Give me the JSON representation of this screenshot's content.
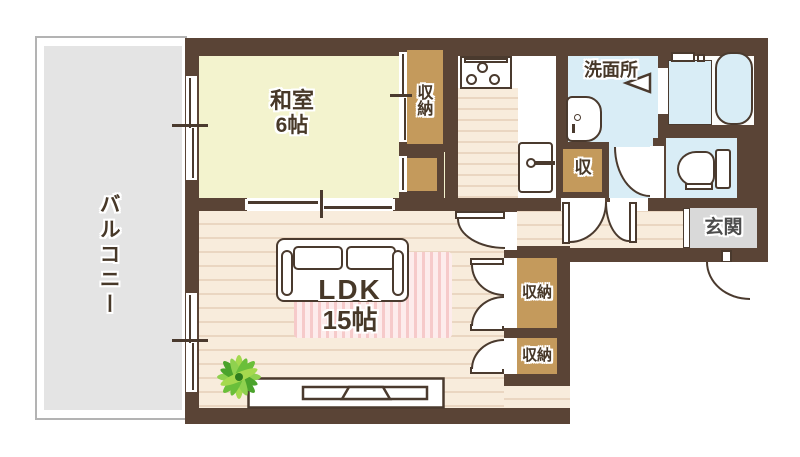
{
  "floorplan": {
    "rooms": {
      "balcony": {
        "label": "バルコニー"
      },
      "japanese_room": {
        "label": "和室",
        "size": "6帖"
      },
      "ldk": {
        "label": "LDK",
        "size": "15帖"
      },
      "washroom": {
        "label": "洗面所"
      },
      "entrance": {
        "label": "玄関"
      },
      "closet_japanese_room": {
        "label": "収納"
      },
      "hall_storage": {
        "label": "収"
      },
      "ldk_storage_upper": {
        "label": "収納"
      },
      "ldk_storage_lower": {
        "label": "収納"
      }
    },
    "colors": {
      "wall": "#5a4436",
      "outline": "#4a3a2e",
      "tatami_room_floor": "#f3f3ce",
      "wood_floor": "#f8ecdc",
      "storage_fill": "#c49a5c",
      "wet_area_floor": "#d9edf6",
      "balcony_floor": "#e4e4e4",
      "entrance_floor": "#d9d9d9",
      "rug_stripe": "#f6caca"
    }
  }
}
